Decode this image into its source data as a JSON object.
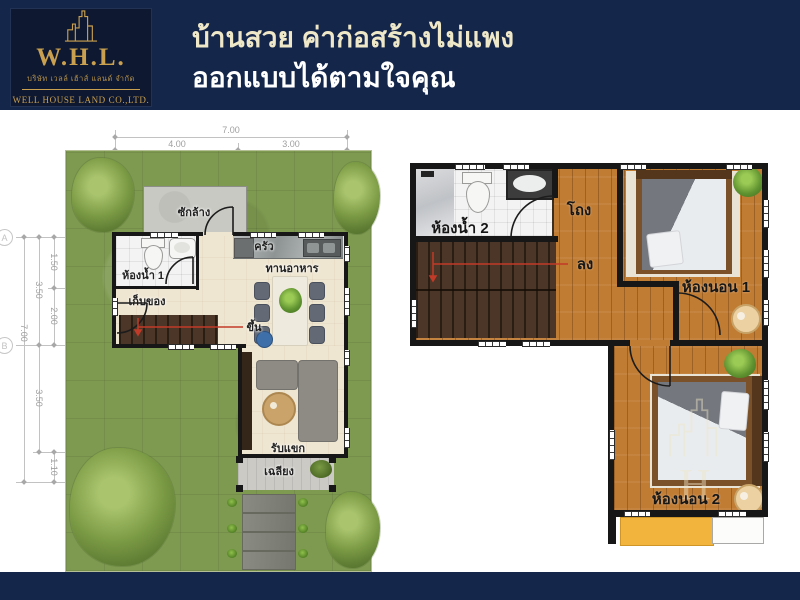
{
  "header": {
    "logo": {
      "abbr": "W.H.L.",
      "thai_company": "บริษัท เวลล์ เฮ้าส์ แลนด์ จำกัด",
      "eng_company": "WELL HOUSE LAND CO.,LTD."
    },
    "title_line1": "บ้านสวย ค่าก่อสร้างไม่แพง",
    "title_line2": "ออกแบบได้ตามใจคุณ"
  },
  "floor1": {
    "rooms": {
      "laundry": "ซักล้าง",
      "bathroom1": "ห้องน้ำ 1",
      "storage": "เก็บของ",
      "kitchen": "ครัว",
      "dining": "ทานอาหาร",
      "stairs_up": "ขึ้น",
      "living": "รับแขก",
      "porch": "เฉลียง"
    },
    "dims_top": {
      "total": "7.00",
      "left": "4.00",
      "right": "3.00",
      "a": "2.50",
      "b": "1.50"
    },
    "dims_left": {
      "total": "7.00",
      "upper": "3.50",
      "lower": "3.50",
      "u1": "1.50",
      "u2": "2.00",
      "bottom": "1.10"
    },
    "grid_markers": {
      "a": "A",
      "b": "B"
    }
  },
  "floor2": {
    "rooms": {
      "bathroom2": "ห้องน้ำ 2",
      "hall": "โถง",
      "stairs_down": "ลง",
      "bedroom1": "ห้องนอน 1",
      "bedroom2": "ห้องนอน 2"
    },
    "watermark_letter": "H"
  },
  "colors": {
    "navy": "#15264b",
    "gold": "#c9a050",
    "cream_title": "#efe8c8",
    "grass_green": "#7e9a50",
    "wood_orange": "#c17c33",
    "stair_brown": "#4c3627",
    "awning_yellow": "#f2b43d",
    "stair_arrow_red": "#c23a28"
  }
}
